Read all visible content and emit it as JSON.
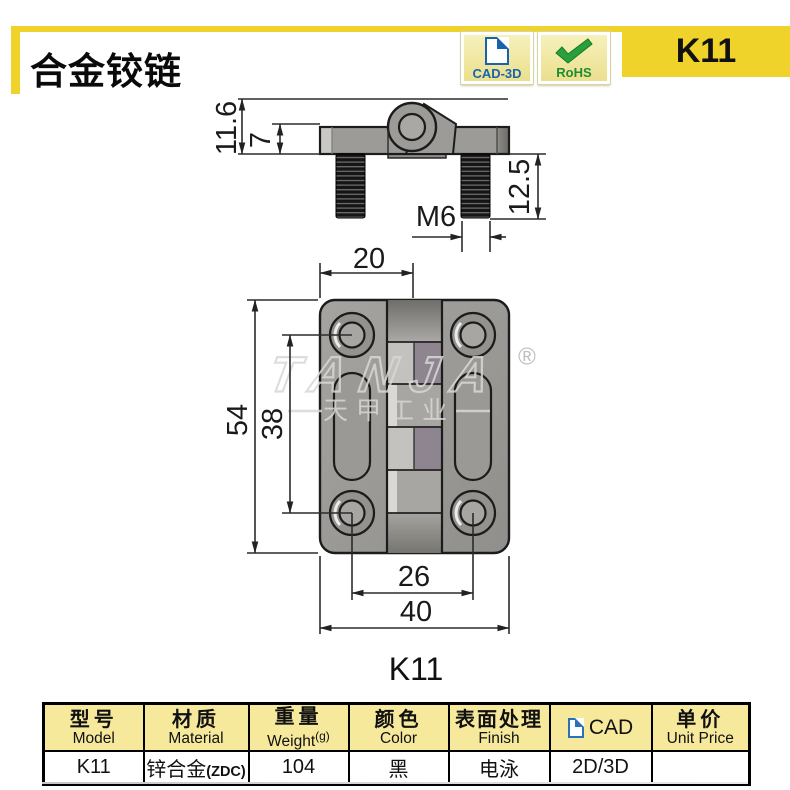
{
  "header": {
    "title": "合金铰链",
    "cad_badge": "CAD-3D",
    "rohs_badge": "RoHS",
    "model": "K11"
  },
  "drawing": {
    "side_view": {
      "total_height": "11.6",
      "leaf_thickness": "7",
      "stud_length": "12.5",
      "thread_spec": "M6"
    },
    "front_view": {
      "hole_to_center": "20",
      "overall_height": "54",
      "hole_pitch_vertical": "38",
      "hole_pitch_horizontal": "26",
      "overall_width": "40"
    },
    "caption": "K11",
    "watermark": {
      "brand": "TANJA",
      "company": "天甲工业",
      "registered": "®"
    }
  },
  "table": {
    "columns": [
      {
        "zh": "型号",
        "en": "Model"
      },
      {
        "zh": "材质",
        "en": "Material"
      },
      {
        "zh": "重量",
        "en": "Weight",
        "unit": "(g)"
      },
      {
        "zh": "颜色",
        "en": "Color"
      },
      {
        "zh": "表面处理",
        "en": "Finish"
      },
      {
        "zh": "CAD",
        "en": ""
      },
      {
        "zh": "单价",
        "en": "Unit Price"
      }
    ],
    "row": {
      "model": "K11",
      "material": "锌合金",
      "material_note": "(ZDC)",
      "weight": "104",
      "color": "黑",
      "finish": "电泳",
      "cad": "2D/3D",
      "unit_price": ""
    }
  },
  "colors": {
    "accent_yellow": "#f0d32a",
    "badge_cream": "#f2eca6",
    "cad_blue": "#1664b0",
    "rohs_green": "#2aa03c",
    "table_header_bg": "#f6e99c",
    "model_cell_bg": "#a6a49f",
    "metal_gray": "#9c9b97",
    "outline_dark": "#1c1c1c",
    "watermark_gray": "#d9d8d6"
  }
}
